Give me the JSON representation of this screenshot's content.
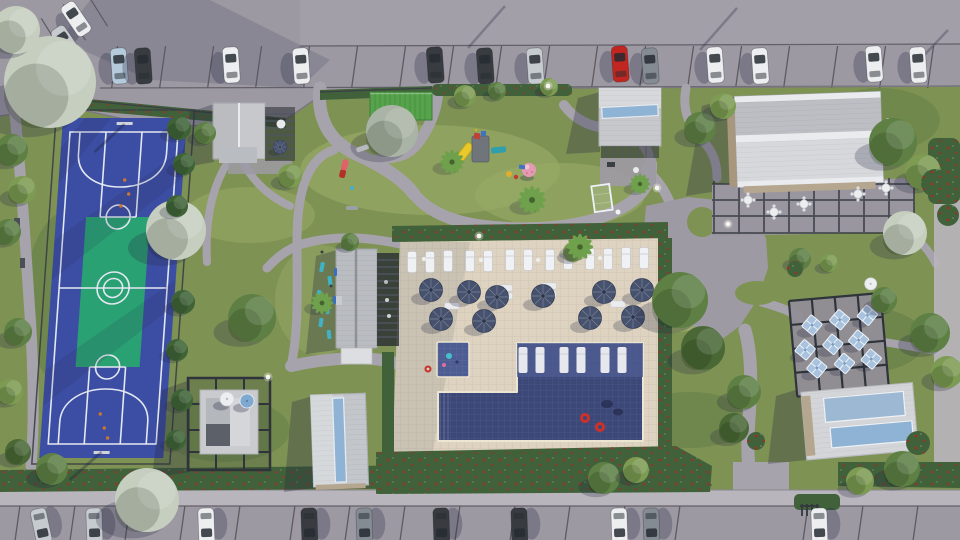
{
  "meta": {
    "kind": "aerial-3d-architectural-render",
    "subject": "community amenity center site plan"
  },
  "palette": {
    "grass": "#7e9254",
    "grass_light": "#9aab66",
    "grass_dark": "#5d7a42",
    "asphalt": "#9d99a3",
    "asphalt_light": "#a8a4ad",
    "sidewalk": "#b9b5bc",
    "path": "#a7a3ac",
    "plaza": "#9e9aa4",
    "deck": "#ddd3c0",
    "pool": "#3c4878",
    "pool_shallow": "#4d5c92",
    "coping": "#ece5d2",
    "hedge": "#41613a",
    "flower_red": "#ab2a20",
    "tree_green": "#5e8045",
    "tree_light": "#7d9b52",
    "conifer": "#3f6337",
    "tree_flower": "#c6cec0",
    "palm": "#6fa14c",
    "court_blue": "#3c4ea4",
    "court_green": "#2aa173",
    "court_line": "#e3e8f2",
    "roof_gray": "#c6c8cc",
    "roof_light": "#d6d8db",
    "roof_ridge": "#e9ebee",
    "roof_tan": "#b9bcc1",
    "skylight": "#8fb3d4",
    "pergola": "#2f343b",
    "wall_tan": "#b5a68f",
    "umbrella_navy": "#46526e",
    "umbrella_blue": "#a9c3de",
    "car_white": "#eceef0",
    "car_silver": "#c6cbd0",
    "car_dark": "#383c41",
    "car_red": "#c22620",
    "car_blue": "#b5cada",
    "car_gray": "#848b92",
    "shadow": "rgba(35,40,64,0.30)"
  },
  "scene": {
    "parking_top": {
      "car_count": 15,
      "car_colors": [
        "white",
        "silver",
        "light-blue",
        "dark",
        "red",
        "gray"
      ]
    },
    "parking_bottom": {
      "car_count": 10
    },
    "basketball_court": {
      "surface": "blue",
      "key_zone": "green",
      "line_color": "white",
      "hoops": 2
    },
    "pool": {
      "shape": "L",
      "in_pool_loungers": 6,
      "red_floats": 2,
      "kiddie_pool": 1
    },
    "pool_deck": {
      "lounge_chairs": 13,
      "navy_umbrellas": 10,
      "side_tables": 4
    },
    "dining_terrace": {
      "light_blue_umbrellas": 9,
      "white_umbrellas": 1
    },
    "clubhouse_patio": {
      "tables": 5
    },
    "playground": {
      "equipment": [
        "yellow-slide",
        "play-tower",
        "teal-bench",
        "pink-ball",
        "soccer-goal"
      ]
    },
    "buildings": [
      "clubhouse",
      "entry-pavilion",
      "restroom-pavilion",
      "pool-house",
      "cabana-pergola",
      "amenity-building",
      "fitness-building"
    ],
    "landscape": [
      "flowering-trees",
      "green-trees",
      "conifers",
      "palm-trees",
      "red-flower-hedges",
      "path-lamps"
    ]
  }
}
